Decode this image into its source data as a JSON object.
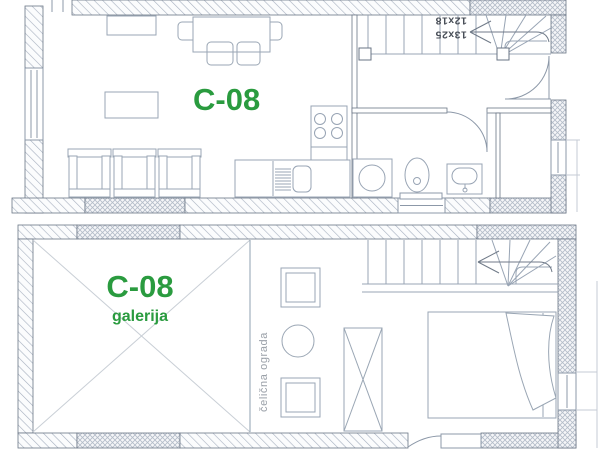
{
  "plans": {
    "ground_floor": {
      "unit_label": "C-08",
      "stair_dimensions": {
        "flight_a": "13x25",
        "flight_b": "12x18"
      }
    },
    "gallery": {
      "unit_label": "C-08",
      "level_label": "galerija",
      "railing_label": "čelična ograda"
    }
  },
  "colors": {
    "label_green": "#2a9b3f",
    "drawing_line": "#98a4b4",
    "wall_edge": "#6a7585",
    "hatch_line": "#a6b0bf",
    "railing_text_gray": "#9aa0a8"
  }
}
